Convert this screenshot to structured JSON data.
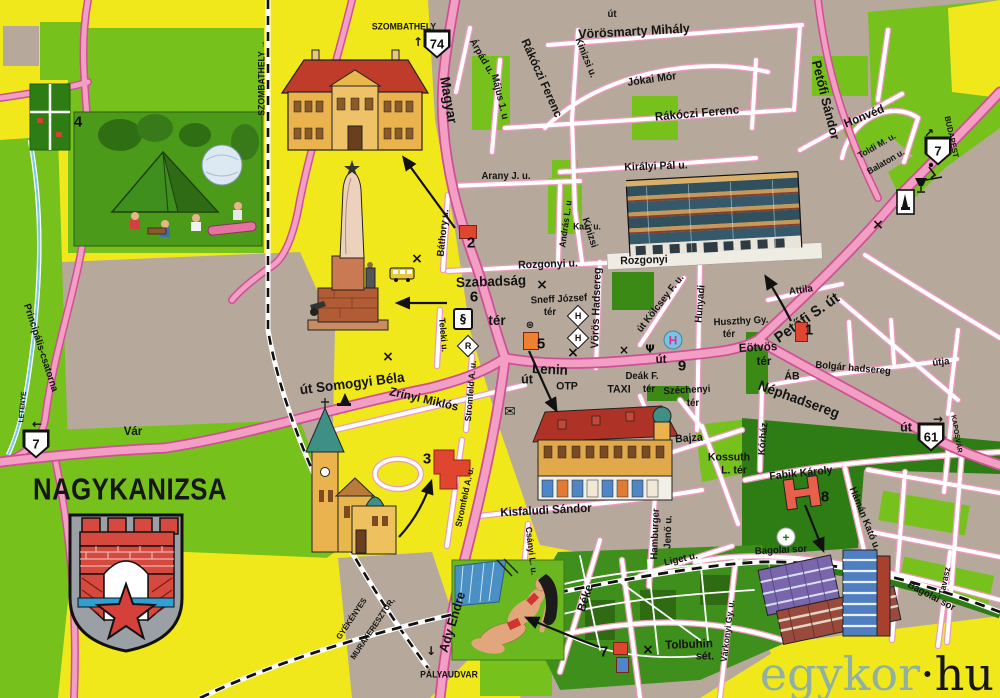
{
  "title": {
    "text": "NAGYKANIZSA"
  },
  "watermark": {
    "left": "egykor",
    "right": "·hu"
  },
  "palette": {
    "land_yellow": "#f1e81c",
    "land_green": "#76c11c",
    "park_dark_green": "#2e7d14",
    "urban_gray": "#b6a99b",
    "road_pink": "#f29fc3",
    "road_edge_pink": "#cf4f96",
    "text_black": "#141414",
    "marker_red": "#e0452f",
    "marker_orange": "#ee8030",
    "watermark_teal": "#8fb0a2"
  },
  "road_badges": [
    {
      "label": "74",
      "x": 437,
      "y": 44
    },
    {
      "label": "7",
      "x": 938,
      "y": 151
    },
    {
      "label": "7",
      "x": 36,
      "y": 444
    },
    {
      "label": "61",
      "x": 931,
      "y": 437
    }
  ],
  "map": {
    "markers": [
      {
        "n": "1",
        "x": 809,
        "y": 330
      },
      {
        "n": "2",
        "x": 471,
        "y": 243
      },
      {
        "n": "3",
        "x": 427,
        "y": 459
      },
      {
        "n": "4",
        "x": 78,
        "y": 122
      },
      {
        "n": "5",
        "x": 541,
        "y": 344
      },
      {
        "n": "6",
        "x": 474,
        "y": 297
      },
      {
        "n": "7",
        "x": 604,
        "y": 652
      },
      {
        "n": "8",
        "x": 825,
        "y": 497
      },
      {
        "n": "9",
        "x": 682,
        "y": 366
      }
    ],
    "labels": [
      {
        "t": "SZOMBATHELY",
        "x": 404,
        "y": 27,
        "r": 0,
        "s": 9
      },
      {
        "t": "Vörösmarty Mihály",
        "x": 634,
        "y": 31,
        "r": -3,
        "s": 13
      },
      {
        "t": "Rákóczi Ferenc",
        "x": 542,
        "y": 78,
        "r": 66,
        "s": 12
      },
      {
        "t": "Jókai Mór",
        "x": 652,
        "y": 80,
        "r": -8,
        "s": 11
      },
      {
        "t": "Rákóczi Ferenc",
        "x": 697,
        "y": 113,
        "r": -5,
        "s": 12
      },
      {
        "t": "Petőfi Sándor",
        "x": 826,
        "y": 100,
        "r": 76,
        "s": 13
      },
      {
        "t": "Honvéd",
        "x": 864,
        "y": 116,
        "r": -22,
        "s": 12
      },
      {
        "t": "Magyar",
        "x": 449,
        "y": 100,
        "r": 80,
        "s": 14
      },
      {
        "t": "Árpád u.",
        "x": 481,
        "y": 57,
        "r": 60,
        "s": 10
      },
      {
        "t": "Május 1. u",
        "x": 499,
        "y": 97,
        "r": 76,
        "s": 10
      },
      {
        "t": "Arany J. u.",
        "x": 506,
        "y": 177,
        "r": 0,
        "s": 10
      },
      {
        "t": "Kinizsi u.",
        "x": 585,
        "y": 58,
        "r": 68,
        "s": 10
      },
      {
        "t": "Kinizsi",
        "x": 589,
        "y": 233,
        "r": 72,
        "s": 10
      },
      {
        "t": "út",
        "x": 612,
        "y": 15,
        "r": 0,
        "s": 10
      },
      {
        "t": "Királyi Pál u.",
        "x": 656,
        "y": 167,
        "r": -2,
        "s": 11
      },
      {
        "t": "Toldi M. u.",
        "x": 877,
        "y": 146,
        "r": -30,
        "s": 9
      },
      {
        "t": "Balaton u.",
        "x": 886,
        "y": 162,
        "r": -30,
        "s": 9
      },
      {
        "t": "BUDAPEST",
        "x": 951,
        "y": 137,
        "r": 78,
        "s": 8
      },
      {
        "t": "Báthory u.",
        "x": 444,
        "y": 233,
        "r": -84,
        "s": 10
      },
      {
        "t": "Kaz. u.",
        "x": 587,
        "y": 227,
        "r": 0,
        "s": 9
      },
      {
        "t": "András L. u",
        "x": 566,
        "y": 224,
        "r": -82,
        "s": 9
      },
      {
        "t": "Rozgonyi u.",
        "x": 548,
        "y": 265,
        "r": -2,
        "s": 11
      },
      {
        "t": "Rozgonyi",
        "x": 644,
        "y": 261,
        "r": -2,
        "s": 11
      },
      {
        "t": "Szabadság",
        "x": 491,
        "y": 281,
        "r": -2,
        "s": 14
      },
      {
        "t": "tér",
        "x": 497,
        "y": 320,
        "r": 0,
        "s": 14
      },
      {
        "t": "Sneff József",
        "x": 559,
        "y": 300,
        "r": -3,
        "s": 10
      },
      {
        "t": "tér",
        "x": 550,
        "y": 313,
        "r": 0,
        "s": 10
      },
      {
        "t": "Vörös Hadsereg",
        "x": 597,
        "y": 308,
        "r": -88,
        "s": 11
      },
      {
        "t": "út Kölcsey F. u.",
        "x": 661,
        "y": 304,
        "r": -52,
        "s": 10
      },
      {
        "t": "Hunyadi",
        "x": 701,
        "y": 304,
        "r": -85,
        "s": 10
      },
      {
        "t": "Attila",
        "x": 801,
        "y": 291,
        "r": -8,
        "s": 10
      },
      {
        "t": "Petőfi S. út",
        "x": 807,
        "y": 318,
        "r": -35,
        "s": 15
      },
      {
        "t": "Huszthy Gy.",
        "x": 741,
        "y": 322,
        "r": -3,
        "s": 10
      },
      {
        "t": "tér",
        "x": 729,
        "y": 335,
        "r": 0,
        "s": 10
      },
      {
        "t": "Eötvös",
        "x": 758,
        "y": 347,
        "r": -3,
        "s": 12
      },
      {
        "t": "tér",
        "x": 764,
        "y": 361,
        "r": 0,
        "s": 12
      },
      {
        "t": "ÁB",
        "x": 792,
        "y": 377,
        "r": 0,
        "s": 11
      },
      {
        "t": "Bolgár hadsereg",
        "x": 853,
        "y": 369,
        "r": 5,
        "s": 10
      },
      {
        "t": "útja",
        "x": 941,
        "y": 363,
        "r": -6,
        "s": 10
      },
      {
        "t": "Néphadsereg",
        "x": 799,
        "y": 399,
        "r": 20,
        "s": 14
      },
      {
        "t": "út",
        "x": 906,
        "y": 427,
        "r": 0,
        "s": 13
      },
      {
        "t": "KAPOSVÁR",
        "x": 956,
        "y": 434,
        "r": 80,
        "s": 7
      },
      {
        "t": "Lenin",
        "x": 550,
        "y": 369,
        "r": 3,
        "s": 14
      },
      {
        "t": "út",
        "x": 527,
        "y": 379,
        "r": 0,
        "s": 13
      },
      {
        "t": "OTP",
        "x": 567,
        "y": 387,
        "r": 0,
        "s": 11
      },
      {
        "t": "TAXI",
        "x": 619,
        "y": 390,
        "r": 0,
        "s": 11
      },
      {
        "t": "Deák F.",
        "x": 642,
        "y": 377,
        "r": 0,
        "s": 10
      },
      {
        "t": "tér",
        "x": 649,
        "y": 390,
        "r": 0,
        "s": 10
      },
      {
        "t": "Széchenyi",
        "x": 687,
        "y": 391,
        "r": -3,
        "s": 10
      },
      {
        "t": "tér",
        "x": 693,
        "y": 404,
        "r": 0,
        "s": 10
      },
      {
        "t": "út",
        "x": 661,
        "y": 359,
        "r": 0,
        "s": 12
      },
      {
        "t": "út Somogyi Béla",
        "x": 352,
        "y": 383,
        "r": -7,
        "s": 14
      },
      {
        "t": "Vár",
        "x": 133,
        "y": 431,
        "r": 0,
        "s": 12
      },
      {
        "t": "LETENYE",
        "x": 23,
        "y": 407,
        "r": -85,
        "s": 7
      },
      {
        "t": "Principális-csatorna",
        "x": 40,
        "y": 348,
        "r": 72,
        "s": 10
      },
      {
        "t": "Zrínyi Miklós",
        "x": 424,
        "y": 399,
        "r": 13,
        "s": 12
      },
      {
        "t": "Teleki u.",
        "x": 443,
        "y": 335,
        "r": 85,
        "s": 9
      },
      {
        "t": "Stromfeld A. u.",
        "x": 471,
        "y": 391,
        "r": -85,
        "s": 9
      },
      {
        "t": "Stromfeld A. u.",
        "x": 465,
        "y": 497,
        "r": -78,
        "s": 9
      },
      {
        "t": "Kisfaludi Sándor",
        "x": 546,
        "y": 510,
        "r": -3,
        "s": 12
      },
      {
        "t": "Csányi L. u.",
        "x": 531,
        "y": 551,
        "r": 83,
        "s": 9
      },
      {
        "t": "Hamburger",
        "x": 656,
        "y": 534,
        "r": -88,
        "s": 10
      },
      {
        "t": "Jenő u.",
        "x": 669,
        "y": 532,
        "r": -88,
        "s": 10
      },
      {
        "t": "Bajza",
        "x": 689,
        "y": 439,
        "r": -4,
        "s": 11
      },
      {
        "t": "Kossuth",
        "x": 729,
        "y": 458,
        "r": 0,
        "s": 11
      },
      {
        "t": "L. tér",
        "x": 734,
        "y": 471,
        "r": 0,
        "s": 11
      },
      {
        "t": "Kórház",
        "x": 764,
        "y": 439,
        "r": -85,
        "s": 10
      },
      {
        "t": "Fabik Károly",
        "x": 801,
        "y": 474,
        "r": -6,
        "s": 11
      },
      {
        "t": "Hámán Kató u.",
        "x": 864,
        "y": 519,
        "r": 68,
        "s": 10
      },
      {
        "t": "Bagolai sor",
        "x": 781,
        "y": 551,
        "r": -3,
        "s": 10
      },
      {
        "t": "Bagolai sor",
        "x": 931,
        "y": 597,
        "r": 28,
        "s": 10
      },
      {
        "t": "Tavasz",
        "x": 945,
        "y": 581,
        "r": -78,
        "s": 9
      },
      {
        "t": "Liget u.",
        "x": 681,
        "y": 560,
        "r": -13,
        "s": 10
      },
      {
        "t": "Tolbuhin",
        "x": 689,
        "y": 644,
        "r": -2,
        "s": 12
      },
      {
        "t": "sét.",
        "x": 705,
        "y": 657,
        "r": 0,
        "s": 11
      },
      {
        "t": "Várkonyi Gy. u.",
        "x": 728,
        "y": 631,
        "r": -83,
        "s": 9
      },
      {
        "t": "Béke",
        "x": 585,
        "y": 598,
        "r": -72,
        "s": 12
      },
      {
        "t": "Ady Endre",
        "x": 452,
        "y": 622,
        "r": -73,
        "s": 13
      },
      {
        "t": "PÁLYAUDVAR",
        "x": 449,
        "y": 675,
        "r": 0,
        "s": 9
      },
      {
        "t": "MURAKERESZTÚR,",
        "x": 373,
        "y": 629,
        "r": -56,
        "s": 8
      },
      {
        "t": "GYÉKÉNYES",
        "x": 352,
        "y": 619,
        "r": -56,
        "s": 8
      },
      {
        "t": "SZOMBATHELY →",
        "x": 262,
        "y": 78,
        "r": -90,
        "s": 9
      }
    ],
    "icons": [
      {
        "name": "marker-1-square",
        "type": "square",
        "x": 795,
        "y": 322,
        "w": 11,
        "h": 18,
        "c": "#e0452f"
      },
      {
        "name": "marker-2-square",
        "type": "square",
        "x": 459,
        "y": 225,
        "w": 16,
        "h": 12,
        "c": "#e0452f"
      },
      {
        "name": "marker-5-square",
        "type": "square",
        "x": 523,
        "y": 332,
        "w": 14,
        "h": 16,
        "c": "#ee8030"
      },
      {
        "name": "marker-7-red-square",
        "type": "square",
        "x": 613,
        "y": 642,
        "w": 13,
        "h": 11,
        "c": "#e0452f"
      },
      {
        "name": "marker-7-blue-square",
        "type": "square",
        "x": 616,
        "y": 657,
        "w": 11,
        "h": 14,
        "c": "#4f86c6"
      },
      {
        "name": "court-section-sign-icon",
        "type": "box",
        "t": "§",
        "x": 463,
        "y": 319
      },
      {
        "name": "restaurant-r-diamond-icon",
        "type": "diamond",
        "t": "R",
        "x": 468,
        "y": 346
      },
      {
        "name": "hotel-h-diamond-icon",
        "type": "diamond",
        "t": "H",
        "x": 578,
        "y": 316
      },
      {
        "name": "hotel-h-diamond-icon",
        "type": "diamond",
        "t": "H",
        "x": 578,
        "y": 338
      },
      {
        "name": "hotel-h-circle-icon",
        "type": "circle",
        "t": "H",
        "x": 673,
        "y": 340,
        "bg": "#74c6e8",
        "fg": "#d8358b"
      },
      {
        "name": "pharmacy-icon",
        "type": "glyph",
        "t": "Ψ",
        "x": 650,
        "y": 349,
        "s": 11
      },
      {
        "name": "hospital-green-cross-icon",
        "type": "circle",
        "t": "+",
        "x": 786,
        "y": 537,
        "bg": "#ffffff",
        "fg": "#1d7c1d"
      },
      {
        "name": "post-office-envelope-icon",
        "type": "glyph",
        "t": "✉",
        "x": 510,
        "y": 412,
        "s": 14
      },
      {
        "name": "railway-emblem-icon",
        "type": "glyph",
        "t": "⊛",
        "x": 530,
        "y": 326,
        "s": 10
      },
      {
        "name": "crossed-swords-icon",
        "type": "glyph",
        "t": "×",
        "x": 417,
        "y": 259,
        "s": 14
      },
      {
        "name": "crossed-swords-icon",
        "type": "glyph",
        "t": "×",
        "x": 542,
        "y": 285,
        "s": 14
      },
      {
        "name": "crossed-swords-icon",
        "type": "glyph",
        "t": "×",
        "x": 573,
        "y": 353,
        "s": 14
      },
      {
        "name": "crossed-swords-icon",
        "type": "glyph",
        "t": "×",
        "x": 388,
        "y": 357,
        "s": 14
      },
      {
        "name": "crossed-swords-icon",
        "type": "glyph",
        "t": "×",
        "x": 878,
        "y": 225,
        "s": 14
      },
      {
        "name": "crossed-swords-icon",
        "type": "glyph",
        "t": "×",
        "x": 648,
        "y": 650,
        "s": 14
      },
      {
        "name": "crossed-swords-icon",
        "type": "glyph",
        "t": "×",
        "x": 624,
        "y": 350,
        "s": 12
      },
      {
        "name": "kaposvar-direction-arrow",
        "type": "glyph",
        "t": "→",
        "x": 938,
        "y": 419,
        "s": 12
      },
      {
        "name": "letenye-direction-arrow",
        "type": "glyph",
        "t": "←",
        "x": 37,
        "y": 424,
        "s": 12
      },
      {
        "name": "szombathely-direction-arrow",
        "type": "glyph",
        "t": "↑",
        "x": 418,
        "y": 42,
        "s": 12
      },
      {
        "name": "budapest-direction-arrow",
        "type": "glyph",
        "t": "↗",
        "x": 929,
        "y": 133,
        "s": 12
      },
      {
        "name": "palyaudvar-direction-arrow",
        "type": "glyph",
        "t": "↓",
        "x": 431,
        "y": 651,
        "s": 12
      }
    ]
  }
}
